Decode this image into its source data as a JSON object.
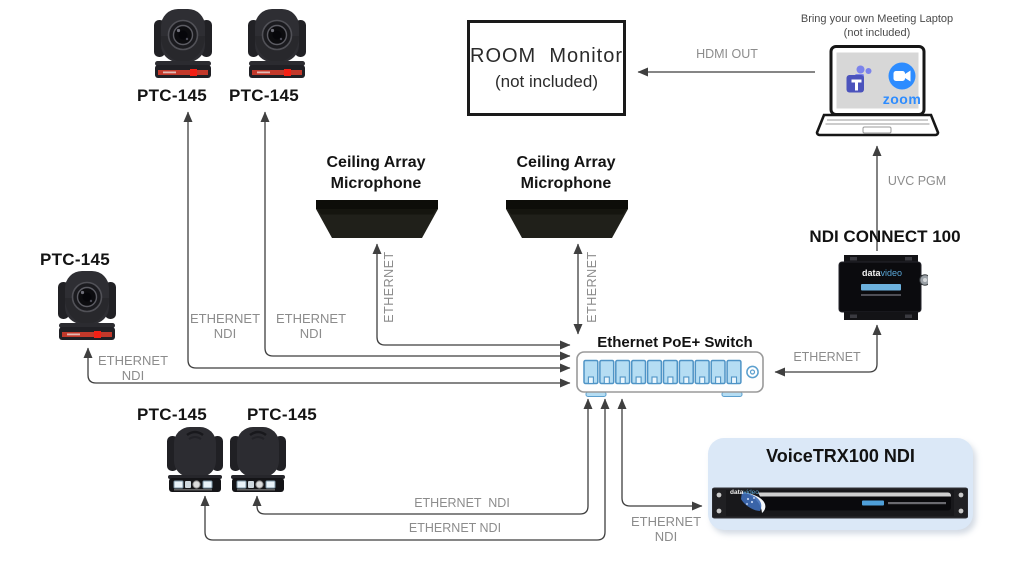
{
  "labels": {
    "ptz_model": "PTC-145",
    "mic": {
      "line1": "Ceiling Array",
      "line2": "Microphone"
    },
    "switch": "Ethernet PoE+ Switch",
    "ndi_connect": "NDI CONNECT 100",
    "voicetrx": "VoiceTRX100 NDI",
    "room_monitor": {
      "line1": "ROOM  Monitor",
      "line2": "(not included)"
    },
    "laptop": {
      "line1": "Bring your own Meeting Laptop",
      "line2": "(not included)"
    }
  },
  "connections": {
    "hdmi_out": "HDMI OUT",
    "uvc_pgm": "UVC PGM",
    "ethernet": "ETHERNET",
    "ethernet_ndi_stacked": {
      "line1": "ETHERNET",
      "line2": "NDI"
    },
    "ethernet_ndi_wide": "ETHERNET  NDI",
    "ethernet_ndi": "ETHERNET NDI"
  },
  "brand": {
    "part1": "data",
    "part2": "video"
  },
  "apps": {
    "zoom_wordmark": "zoom"
  },
  "switch_ports": {
    "count": 10
  },
  "colors": {
    "line": "#3f3f3f",
    "gray_label": "#8c8c8c",
    "camera_red": "#f32015",
    "teams_purple": "#4b53bc",
    "teams_light_purple": "#7b83eb",
    "zoom_blue": "#2d8cff",
    "port_blue": "#b5ddf3",
    "port_border_blue": "#4f94c6",
    "voicetrx_card": "#dbe8f7",
    "ndi_strip_blue": "#6cb1dd"
  }
}
